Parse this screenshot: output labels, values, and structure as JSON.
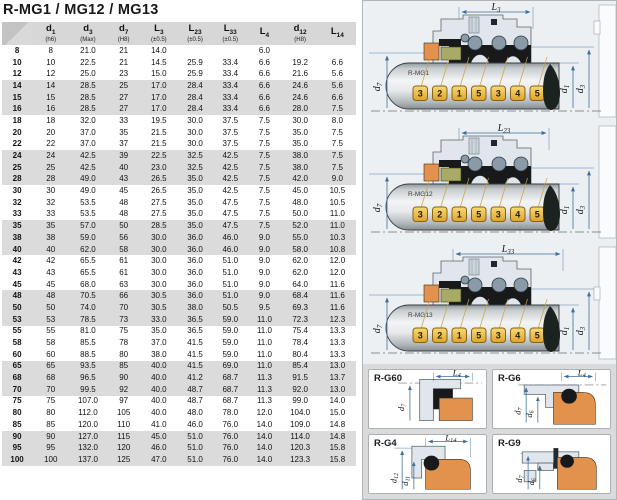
{
  "title": "R-MG1 / MG12 / MG13",
  "table": {
    "headers": [
      {
        "sym": "",
        "sub": "",
        "note": ""
      },
      {
        "sym": "d",
        "sub": "1",
        "note": "(h6)"
      },
      {
        "sym": "d",
        "sub": "3",
        "note": "(Max)"
      },
      {
        "sym": "d",
        "sub": "7",
        "note": "(H8)"
      },
      {
        "sym": "L",
        "sub": "3",
        "note": "(±0.5)"
      },
      {
        "sym": "L",
        "sub": "23",
        "note": "(±0.5)"
      },
      {
        "sym": "L",
        "sub": "33",
        "note": "(±0.5)"
      },
      {
        "sym": "L",
        "sub": "4",
        "note": ""
      },
      {
        "sym": "d",
        "sub": "12",
        "note": "(H8)"
      },
      {
        "sym": "L",
        "sub": "14",
        "note": ""
      }
    ],
    "rows": [
      [
        "8",
        "8",
        "21.0",
        "21",
        "14.0",
        "",
        "",
        "6.0",
        "",
        ""
      ],
      [
        "10",
        "10",
        "22.5",
        "21",
        "14.5",
        "25.9",
        "33.4",
        "6.6",
        "19.2",
        "6.6"
      ],
      [
        "12",
        "12",
        "25.0",
        "23",
        "15.0",
        "25.9",
        "33.4",
        "6.6",
        "21.6",
        "5.6"
      ],
      [
        "14",
        "14",
        "28.5",
        "25",
        "17.0",
        "28.4",
        "33.4",
        "6.6",
        "24.6",
        "5.6"
      ],
      [
        "15",
        "15",
        "28.5",
        "27",
        "17.0",
        "28.4",
        "33.4",
        "6.6",
        "24.6",
        "6.6"
      ],
      [
        "16",
        "16",
        "28.5",
        "27",
        "17.0",
        "28.4",
        "33.4",
        "6.6",
        "28.0",
        "7.5"
      ],
      [
        "18",
        "18",
        "32.0",
        "33",
        "19.5",
        "30.0",
        "37.5",
        "7.5",
        "30.0",
        "8.0"
      ],
      [
        "20",
        "20",
        "37.0",
        "35",
        "21.5",
        "30.0",
        "37.5",
        "7.5",
        "35.0",
        "7.5"
      ],
      [
        "22",
        "22",
        "37.0",
        "37",
        "21.5",
        "30.0",
        "37.5",
        "7.5",
        "35.0",
        "7.5"
      ],
      [
        "24",
        "24",
        "42.5",
        "39",
        "22.5",
        "32.5",
        "42.5",
        "7.5",
        "38.0",
        "7.5"
      ],
      [
        "25",
        "25",
        "42.5",
        "40",
        "23.0",
        "32.5",
        "42.5",
        "7.5",
        "38.0",
        "7.5"
      ],
      [
        "28",
        "28",
        "49.0",
        "43",
        "26.5",
        "35.0",
        "42.5",
        "7.5",
        "42.0",
        "9.0"
      ],
      [
        "30",
        "30",
        "49.0",
        "45",
        "26.5",
        "35.0",
        "42.5",
        "7.5",
        "45.0",
        "10.5"
      ],
      [
        "32",
        "32",
        "53.5",
        "48",
        "27.5",
        "35.0",
        "47.5",
        "7.5",
        "48.0",
        "10.5"
      ],
      [
        "33",
        "33",
        "53.5",
        "48",
        "27.5",
        "35.0",
        "47.5",
        "7.5",
        "50.0",
        "11.0"
      ],
      [
        "35",
        "35",
        "57.0",
        "50",
        "28.5",
        "35.0",
        "47.5",
        "7.5",
        "52.0",
        "11.0"
      ],
      [
        "38",
        "38",
        "59.0",
        "56",
        "30.0",
        "36.0",
        "46.0",
        "9.0",
        "55.0",
        "10.3"
      ],
      [
        "40",
        "40",
        "62.0",
        "58",
        "30.0",
        "36.0",
        "46.0",
        "9.0",
        "58.0",
        "10.8"
      ],
      [
        "42",
        "42",
        "65.5",
        "61",
        "30.0",
        "36.0",
        "51.0",
        "9.0",
        "62.0",
        "12.0"
      ],
      [
        "43",
        "43",
        "65.5",
        "61",
        "30.0",
        "36.0",
        "51.0",
        "9.0",
        "62.0",
        "12.0"
      ],
      [
        "45",
        "45",
        "68.0",
        "63",
        "30.0",
        "36.0",
        "51.0",
        "9.0",
        "64.0",
        "11.6"
      ],
      [
        "48",
        "48",
        "70.5",
        "66",
        "30.5",
        "36.0",
        "51.0",
        "9.0",
        "68.4",
        "11.6"
      ],
      [
        "50",
        "50",
        "74.0",
        "70",
        "30.5",
        "38.0",
        "50.5",
        "9.5",
        "69.3",
        "11.6"
      ],
      [
        "53",
        "53",
        "78.5",
        "73",
        "33.0",
        "36.5",
        "59.0",
        "11.0",
        "72.3",
        "12.3"
      ],
      [
        "55",
        "55",
        "81.0",
        "75",
        "35.0",
        "36.5",
        "59.0",
        "11.0",
        "75.4",
        "13.3"
      ],
      [
        "58",
        "58",
        "85.5",
        "78",
        "37.0",
        "41.5",
        "59.0",
        "11.0",
        "78.4",
        "13.3"
      ],
      [
        "60",
        "60",
        "88.5",
        "80",
        "38.0",
        "41.5",
        "59.0",
        "11.0",
        "80.4",
        "13.3"
      ],
      [
        "65",
        "65",
        "93.5",
        "85",
        "40.0",
        "41.5",
        "69.0",
        "11.0",
        "85.4",
        "13.0"
      ],
      [
        "68",
        "68",
        "96.5",
        "90",
        "40.0",
        "41.2",
        "68.7",
        "11.3",
        "91.5",
        "13.7"
      ],
      [
        "70",
        "70",
        "99.5",
        "92",
        "40.0",
        "48.7",
        "68.7",
        "11.3",
        "92.0",
        "13.0"
      ],
      [
        "75",
        "75",
        "107.0",
        "97",
        "40.0",
        "48.7",
        "68.7",
        "11.3",
        "99.0",
        "14.0"
      ],
      [
        "80",
        "80",
        "112.0",
        "105",
        "40.0",
        "48.0",
        "78.0",
        "12.0",
        "104.0",
        "15.0"
      ],
      [
        "85",
        "85",
        "120.0",
        "110",
        "41.0",
        "46.0",
        "76.0",
        "14.0",
        "109.0",
        "14.8"
      ],
      [
        "90",
        "90",
        "127.0",
        "115",
        "45.0",
        "51.0",
        "76.0",
        "14.0",
        "114.0",
        "14.8"
      ],
      [
        "95",
        "95",
        "132.0",
        "120",
        "46.0",
        "51.0",
        "76.0",
        "14.0",
        "120.3",
        "15.8"
      ],
      [
        "100",
        "100",
        "137.0",
        "125",
        "47.0",
        "51.0",
        "76.0",
        "14.0",
        "123.3",
        "15.8"
      ]
    ]
  },
  "seal_tags": [
    "3",
    "2",
    "1",
    "5",
    "3",
    "4",
    "5"
  ],
  "diagrams": [
    {
      "name": "R-MG1",
      "dim_sym": "L",
      "dim_sub": "3",
      "left_sym": "d",
      "left_sub": "7",
      "right1_sym": "d",
      "right1_sub": "1",
      "right2_sym": "d",
      "right2_sub": "3"
    },
    {
      "name": "R-MG12",
      "dim_sym": "L",
      "dim_sub": "23",
      "left_sym": "d",
      "left_sub": "7",
      "right1_sym": "d",
      "right1_sub": "1",
      "right2_sym": "d",
      "right2_sub": "3"
    },
    {
      "name": "R-MG13",
      "dim_sym": "L",
      "dim_sub": "33",
      "left_sym": "d",
      "left_sub": "7",
      "right1_sym": "d",
      "right1_sub": "1",
      "right2_sym": "d",
      "right2_sub": "3"
    }
  ],
  "detail_panels": [
    {
      "name": "R-G60",
      "dim_sym": "L",
      "dim_sub": "4",
      "dims": [
        {
          "sym": "d",
          "sub": "7"
        },
        {
          "sym": "",
          "sub": ""
        }
      ]
    },
    {
      "name": "R-G6",
      "dim_sym": "L",
      "dim_sub": "4",
      "dims": [
        {
          "sym": "d",
          "sub": "7"
        },
        {
          "sym": "d",
          "sub": "6"
        }
      ]
    },
    {
      "name": "R-G4",
      "dim_sym": "L",
      "dim_sub": "14",
      "dims": [
        {
          "sym": "d",
          "sub": "12"
        },
        {
          "sym": "d",
          "sub": "11"
        }
      ]
    },
    {
      "name": "R-G9",
      "dim_sym": "",
      "dim_sub": "",
      "dims": [
        {
          "sym": "d",
          "sub": "7"
        },
        {
          "sym": "d",
          "sub": "6"
        }
      ]
    }
  ],
  "colors": {
    "accent_dim": "#3c6e9f",
    "tag_fill": "#f2c94c",
    "seal_orange": "#e2924d",
    "seal_olive": "#a8ab68",
    "band_gray": "#dbdbdb"
  }
}
